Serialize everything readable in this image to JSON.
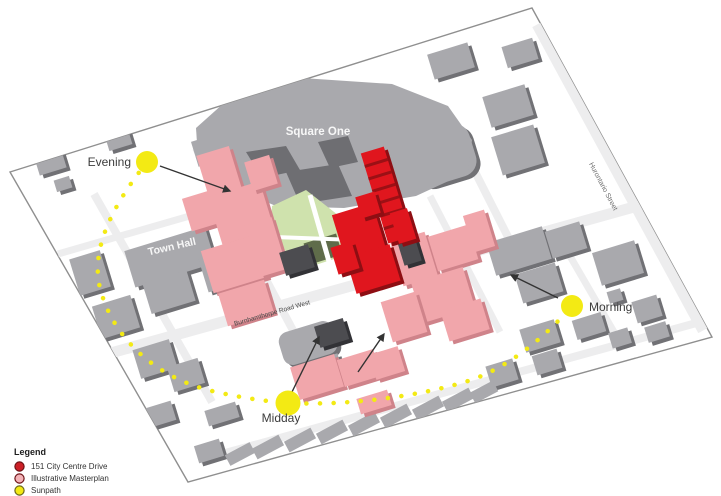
{
  "map": {
    "labels": {
      "square_one": "Square One",
      "town_hall": "Town Hall",
      "burnhamthorpe": "Burnhamthorpe Road West",
      "hurontario": "Hurontario Street"
    },
    "sun_markers": [
      {
        "id": "evening",
        "label": "Evening"
      },
      {
        "id": "midday",
        "label": "Midday"
      },
      {
        "id": "morning",
        "label": "Morning"
      }
    ]
  },
  "legend": {
    "title": "Legend",
    "items": [
      {
        "label": "151 City Centre Drive",
        "color": "#cc2027"
      },
      {
        "label": "Illustrative Masterplan",
        "color": "#f4b3b8"
      },
      {
        "label": "Sunpath",
        "color": "#f3ea14"
      }
    ]
  },
  "colors": {
    "site_red": "#e0161e",
    "masterplan_pink": "#f1a6ab",
    "sunpath_yellow": "#f3ea14",
    "context_gray": "#a9a9ad",
    "green_space": "#cfe2ad"
  }
}
